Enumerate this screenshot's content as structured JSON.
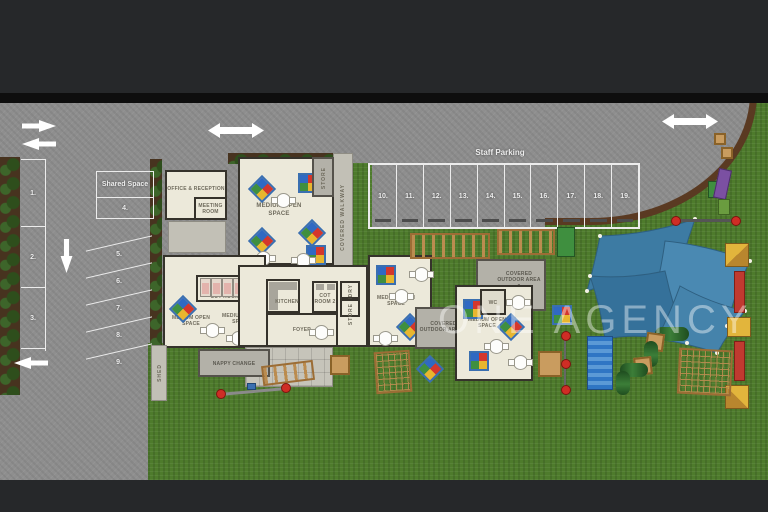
{
  "watermark": "ONE AGENCY",
  "parking": {
    "staff_label": "Staff Parking",
    "staff_bays": [
      "10.",
      "11.",
      "12.",
      "13.",
      "14.",
      "15.",
      "16.",
      "17.",
      "18.",
      "19."
    ],
    "street_bays": [
      "1.",
      "2.",
      "3."
    ],
    "shared_space": {
      "label": "Shared Space",
      "bay": "4."
    },
    "angled_bays": [
      "5.",
      "6.",
      "7.",
      "8.",
      "9."
    ]
  },
  "rooms": {
    "office_reception": "OFFICE & RECEPTION",
    "meeting_room": "MEETING ROOM",
    "open_space_1": "MEDIUM OPEN SPACE",
    "open_space_2": "MEDIUM OPEN SPACE",
    "open_space_3": "MEDIUM OPEN SPACE",
    "open_space_4": "MEDIUM OPEN SPACE",
    "open_space_5": "MEDIUM OPEN SPACE",
    "cot_room_1": "COT ROOM",
    "cot_room_2": "COT ROOM 2",
    "kitchen": "KITCHEN",
    "foyer": "FOYER",
    "laundry": "LAUNDRY",
    "store_1": "STORE",
    "store_2": "STORE",
    "wc": "WC",
    "nappy_change": "NAPPY CHANGE",
    "shed": "SHED",
    "covered_walkway": "COVERED WALKWAY",
    "covered_outdoor_1": "COVERED OUTDOOR AREA 1",
    "covered_outdoor_2": "COVERED OUTDOOR AREA 2"
  },
  "colors": {
    "frame": "#26282a",
    "asphalt": "#8e8e8e",
    "grass": "#4e7b2c",
    "floor": "#ece9da",
    "concrete": "#b3b1a8",
    "sail_blue": "#4380aa",
    "line_white": "#ececec"
  }
}
